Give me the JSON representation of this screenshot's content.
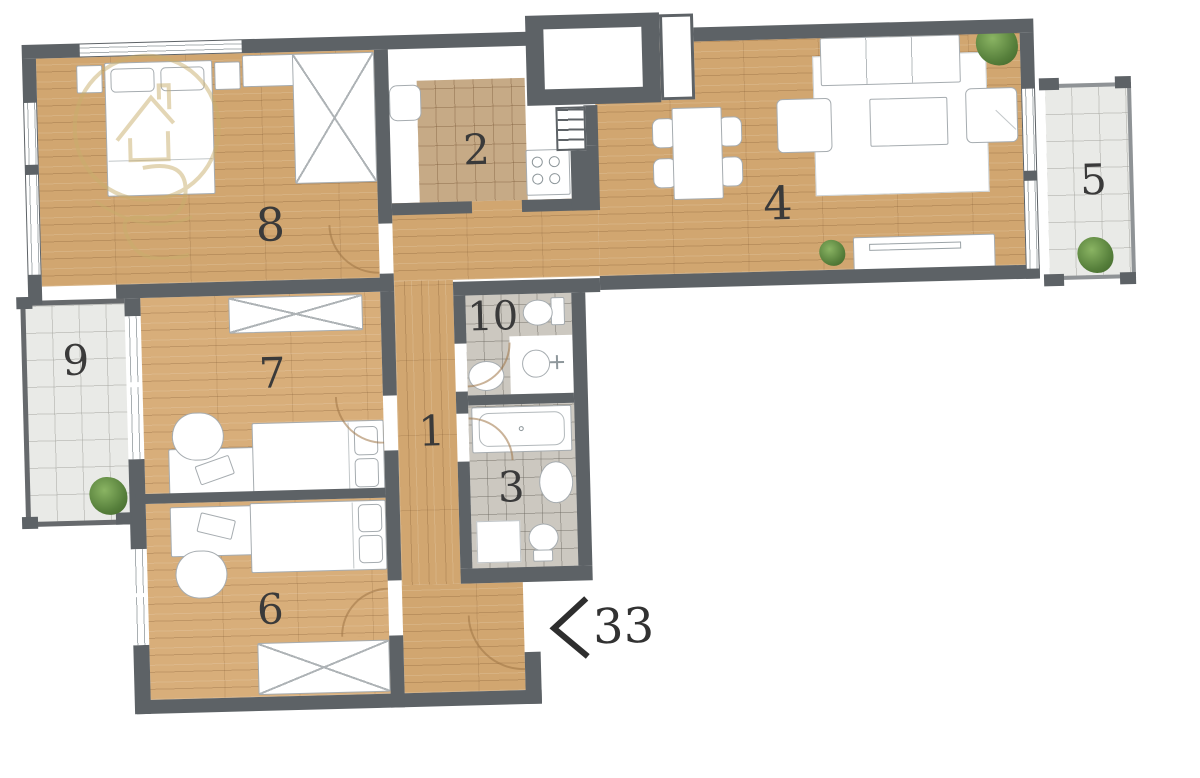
{
  "plan_title": "apartment-floor-plan",
  "rooms": [
    {
      "number": "1",
      "name": "hallway"
    },
    {
      "number": "2",
      "name": "kitchen"
    },
    {
      "number": "3",
      "name": "bathroom"
    },
    {
      "number": "4",
      "name": "living-dining-room"
    },
    {
      "number": "5",
      "name": "balcony-right"
    },
    {
      "number": "6",
      "name": "bedroom-lower"
    },
    {
      "number": "7",
      "name": "bedroom-middle"
    },
    {
      "number": "8",
      "name": "bedroom-upper"
    },
    {
      "number": "9",
      "name": "balcony-left"
    },
    {
      "number": "10",
      "name": "bathroom-wc"
    }
  ],
  "entrance": {
    "label": "33",
    "direction": "left"
  },
  "colors": {
    "wall": "#5d6266",
    "wood": "#d1a670",
    "wood_light": "#d8ae7a",
    "kitchen_tile": "#c6aa86",
    "bath_tile": "#ccc8c0",
    "balcony_tile": "#e9eae7",
    "plant": "#567f3b",
    "watermark": "#c9ae6d",
    "label_text": "#3a3a3a",
    "background": "#ffffff"
  }
}
